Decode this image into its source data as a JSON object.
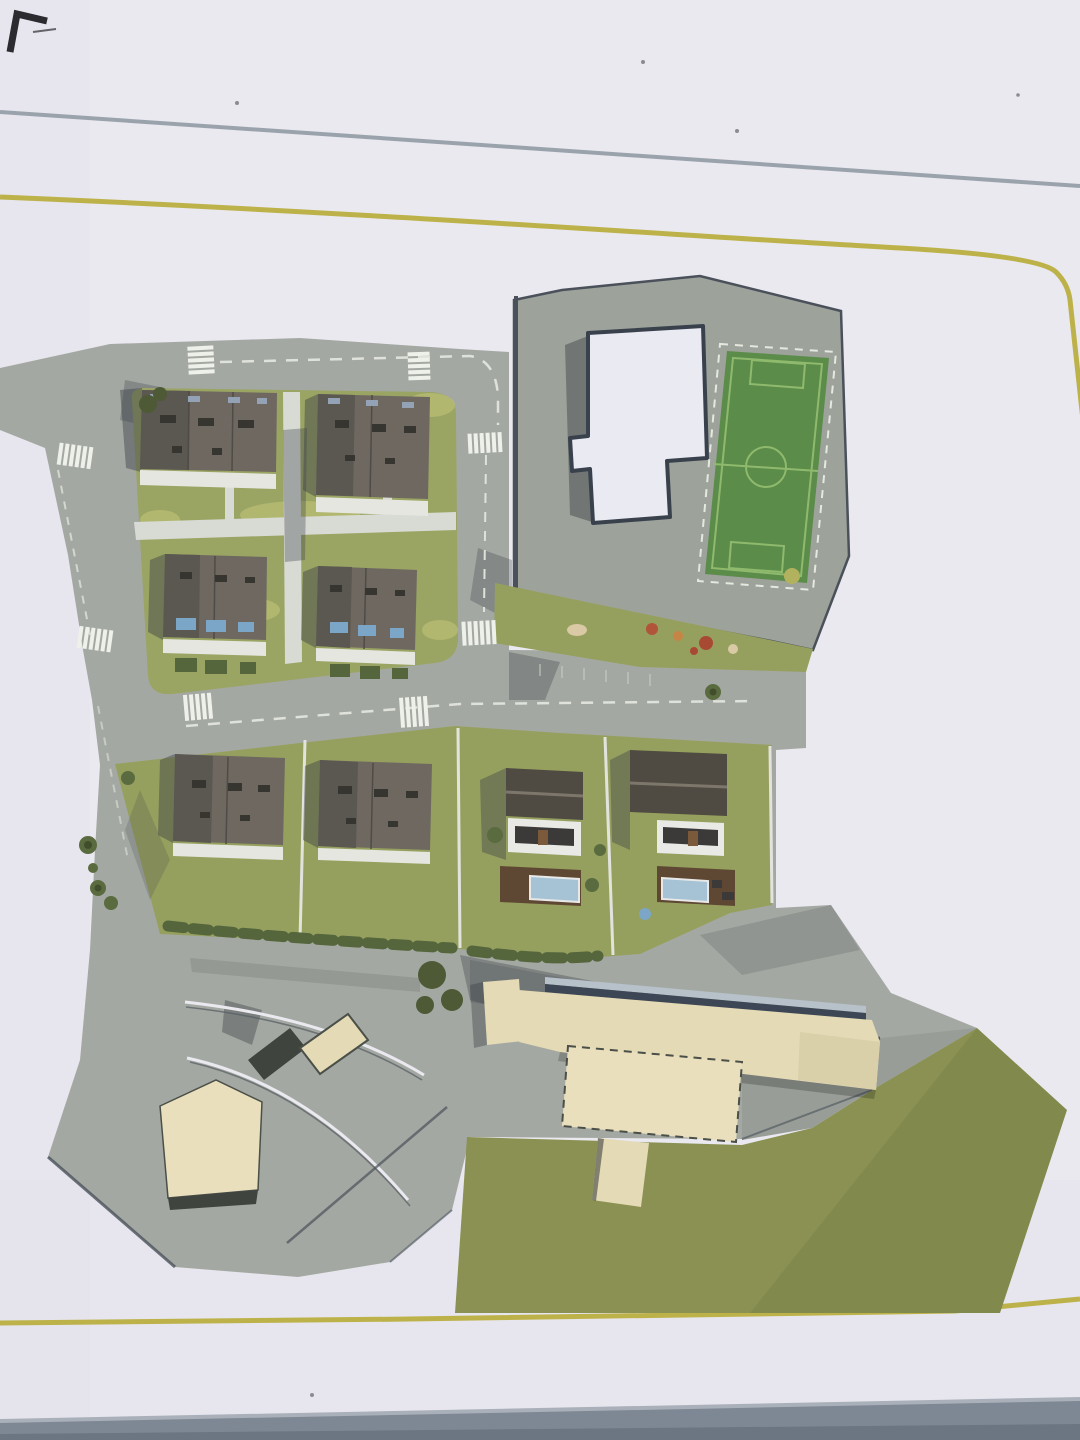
{
  "scene": {
    "kind": "photograph of a printed aerial 3D site-plan rendering",
    "features": [
      "north residential block with four apartment buildings and lawns",
      "paved block with L-shaped white-roofed building and soccer pitch",
      "lawn strip with playground equipment",
      "middle road with zebra crossings and parking",
      "south row with two apartment buildings and two detached houses with decks and pools",
      "large cream communal building complex",
      "big meadow lawn",
      "paved apron with curved road and two small cream buildings",
      "thin grey rule and yellow rounded-corner border printed on the page",
      "dark pen mark in the top-left corner",
      "grey table surface visible below the bottom paper edge"
    ]
  },
  "palette": {
    "paper": "#eae9f0",
    "paper_shade": "#e2e1ea",
    "table_band": "#7e8794",
    "table_band_light": "#aab0b9",
    "table_band_dark": "#6c7582",
    "rule_gray": "#9aa3ac",
    "rule_yellow": "#bdb24a",
    "road": "#a4a8a2",
    "ramp": "#989d97",
    "road_seam": "#4a515a",
    "parking_tick": "#c9cec5",
    "soccer_block": "#9da29b",
    "school_roof": "#eaeaf2",
    "school_outline": "#39414d",
    "pitch_green": "#5b8c49",
    "pitch_line": "#8fba6e",
    "pitch_dash": "#e4e8df",
    "block_lawn": "#9aa463",
    "lawn_light": "#b8bb72",
    "garden_lawn": "#96a05e",
    "big_lawn": "#8a9152",
    "path_white": "#d8dad4",
    "terrace": "#e6e6e1",
    "fence": "#e3e3de",
    "apt_roof": "#6e6860",
    "apt_roof_dark": "#5b5751",
    "roof_seam": "#4f4b46",
    "roof_vent": "#37352f",
    "dormer": "#93a2b5",
    "window_blue": "#7ba6c7",
    "house_roof": "#4f4a42",
    "house_ridge": "#7d766b",
    "facade": "#e9e9e6",
    "window_strip": "#3c3a38",
    "door_brown": "#7a5a3a",
    "deck": "#5f4833",
    "pool": "#a6c3d6",
    "pool_rim": "#e8e8e8",
    "hedge": "#55663d",
    "tree": "#5a6b3f",
    "tree_core": "#414e2c",
    "bush": "#4d5a35",
    "beige": "#e4dab6",
    "beige_light": "#eadfbd",
    "beige_dark": "#d9cfa9",
    "beige_edge": "#4a4f48",
    "navy_strip": "#3d4654",
    "steel_strip": "#b7c1ca",
    "shadow": "#3b4148",
    "dark_bar": "#3f443f",
    "arc_white": "#e9e9ef",
    "arc_dark": "#565c62",
    "play_red": "#b0543a",
    "play_orange": "#c68544",
    "play_rust": "#a84a33",
    "sand": "#d9c9a4",
    "olive_tree": "#b2b25e",
    "crosswalk": "#eef0ea",
    "centerline": "#dfe2da",
    "pen_mark": "#2b2b30",
    "speck": "#8b8b93"
  }
}
